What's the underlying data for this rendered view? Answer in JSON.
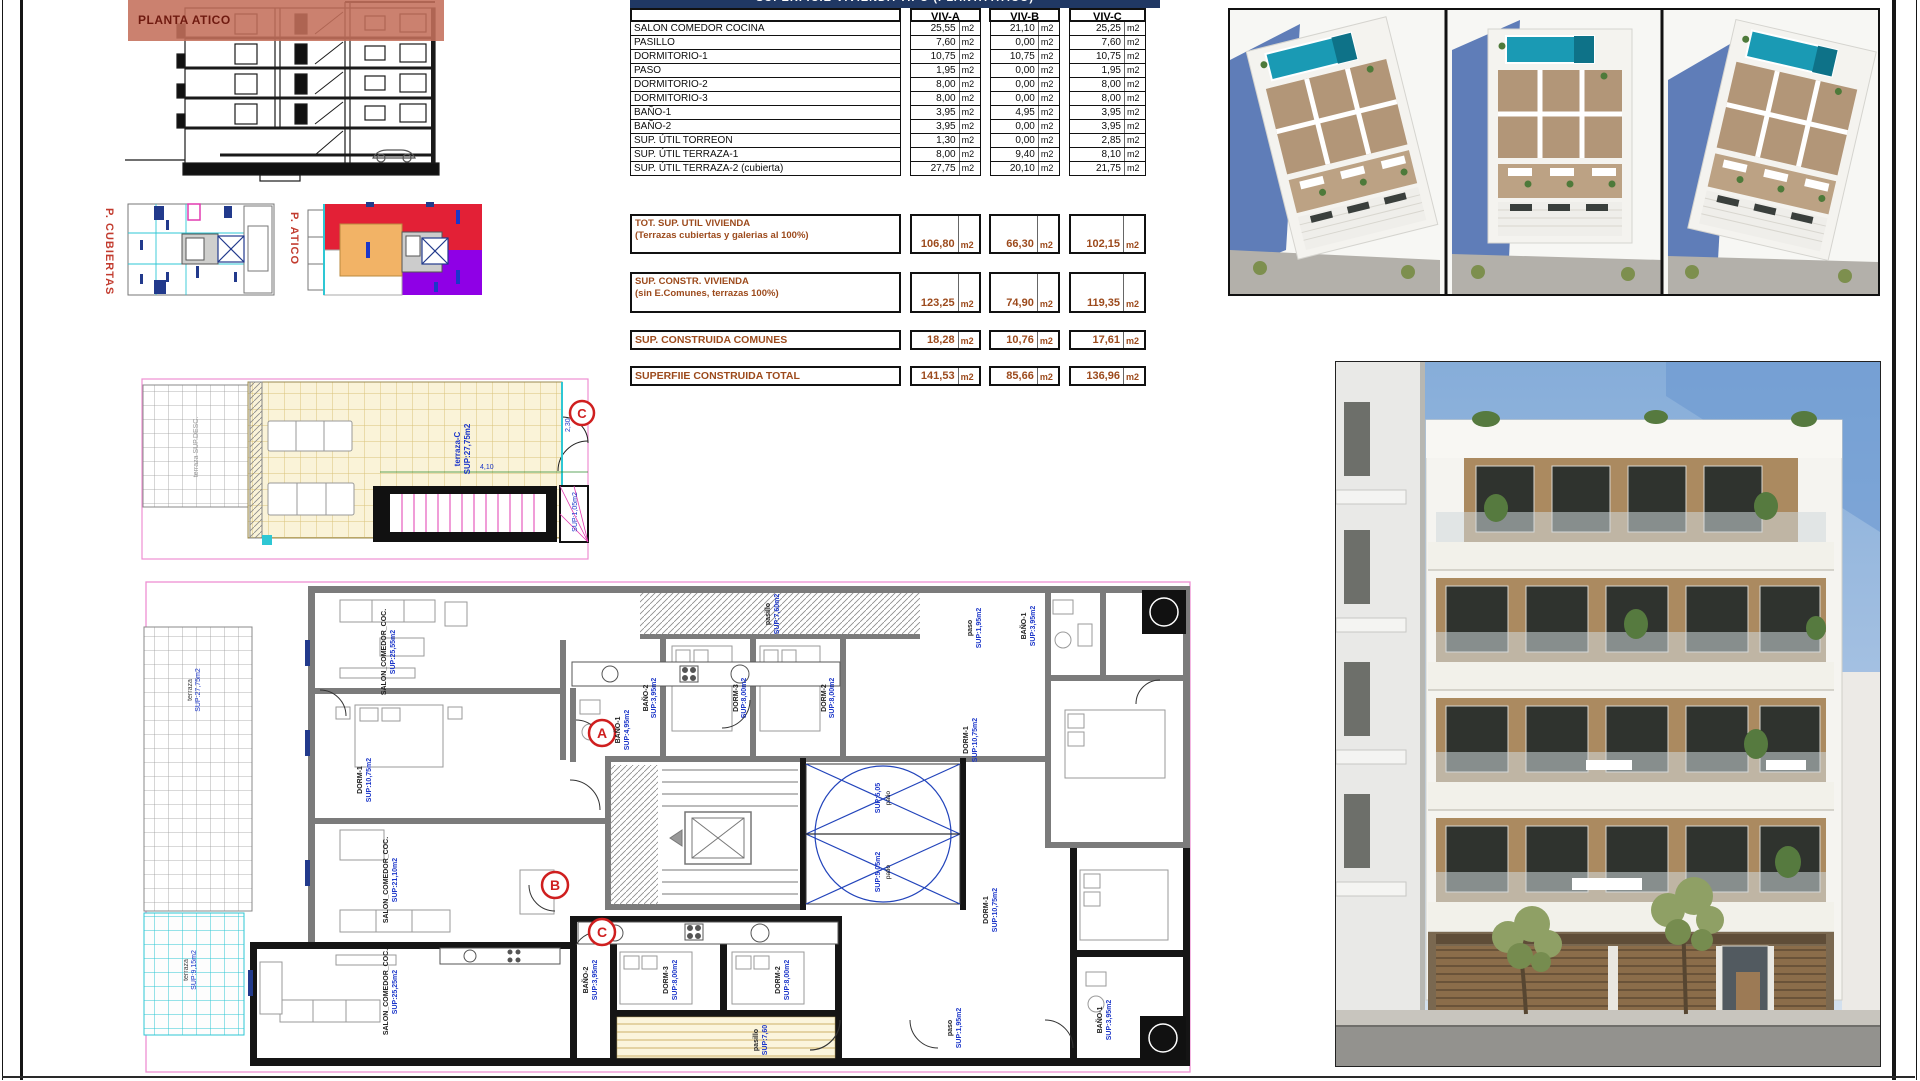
{
  "sheet": {
    "section_label": "PLANTA ATICO",
    "roof_plan_label": "P. CUBIERTAS",
    "atico_plan_label": "P. ATICO"
  },
  "table": {
    "title": "SUPERFICIE VIVIENDA TIPO (PLANTA ATICO)",
    "columns": [
      "VIV-A",
      "VIV-B",
      "VIV-C"
    ],
    "unit": "m2",
    "rows": [
      {
        "label": "SALON COMEDOR COCINA",
        "values": [
          "25,55",
          "21,10",
          "25,25"
        ]
      },
      {
        "label": "PASILLO",
        "values": [
          "7,60",
          "0,00",
          "7,60"
        ]
      },
      {
        "label": "DORMITORIO-1",
        "values": [
          "10,75",
          "10,75",
          "10,75"
        ]
      },
      {
        "label": "PASO",
        "values": [
          "1,95",
          "0,00",
          "1,95"
        ]
      },
      {
        "label": "DORMITORIO-2",
        "values": [
          "8,00",
          "0,00",
          "8,00"
        ]
      },
      {
        "label": "DORMITORIO-3",
        "values": [
          "8,00",
          "0,00",
          "8,00"
        ]
      },
      {
        "label": "BAÑO-1",
        "values": [
          "3,95",
          "4,95",
          "3,95"
        ]
      },
      {
        "label": "BAÑO-2",
        "values": [
          "3,95",
          "0,00",
          "3,95"
        ]
      },
      {
        "label": "SUP. ÚTIL TORREON",
        "values": [
          "1,30",
          "0,00",
          "2,85"
        ]
      },
      {
        "label": "SUP. ÚTIL TERRAZA-1",
        "values": [
          "8,00",
          "9,40",
          "8,10"
        ]
      },
      {
        "label": "SUP. ÚTIL TERRAZA-2 (cubierta)",
        "values": [
          "27,75",
          "20,10",
          "21,75"
        ]
      }
    ],
    "summary_rows": [
      {
        "label": "TOT. SUP. UTIL VIVIENDA",
        "sublabel": "(Terrazas cubiertas y galerias al 100%)",
        "values": [
          "106,80",
          "66,30",
          "102,15"
        ],
        "twoLine": true,
        "gap": 38,
        "height": 40
      },
      {
        "label": "SUP. CONSTR. VIVIENDA",
        "sublabel": "(sin E.Comunes, terrazas 100%)",
        "values": [
          "123,25",
          "74,90",
          "119,35"
        ],
        "twoLine": true,
        "gap": 18,
        "height": 41
      },
      {
        "label": "SUP. CONSTRUIDA COMUNES",
        "sublabel": "",
        "values": [
          "18,28",
          "10,76",
          "17,61"
        ],
        "twoLine": false,
        "gap": 17,
        "height": 20
      },
      {
        "label": "SUPERFIIE CONSTRUIDA TOTAL",
        "sublabel": "",
        "values": [
          "141,53",
          "85,66",
          "136,96"
        ],
        "twoLine": false,
        "gap": 16,
        "height": 20
      }
    ]
  },
  "terrace_plan": {
    "marker": "C",
    "room_label": "terraza-C",
    "area_label": "SUP:27,75m2",
    "stair_area_label": "SUP:1,05m2",
    "dim_a": "2,30",
    "dim_b": "4,10"
  },
  "floor_plan": {
    "markers": {
      "a": "A",
      "b": "B",
      "c": "C"
    },
    "labels": {
      "salon_a": "SALON_COMEDOR_COC.",
      "salon_a_area": "SUP:25,55m2",
      "salon_b": "SALON_COMEDOR_COC.",
      "salon_b_area": "SUP:21,10m2",
      "salon_c": "SALON_COMEDOR_COC.",
      "salon_c_area": "SUP:25,25m2",
      "dorm1_a": "DORM-1",
      "dorm1_a_area": "SUP:10,75m2",
      "bano1_b": "BAÑO-1",
      "bano1_b_area": "SUP:4,95m2",
      "bano2_top": "BAÑO-2",
      "bano2_top_area": "SUP:3,95m2",
      "dorm3_top": "DORM-3",
      "dorm3_top_area": "SUP:8,00m2",
      "dorm2_top": "DORM-2",
      "dorm2_top_area": "SUP:8,00m2",
      "pasillo_top": "pasillo",
      "pasillo_top_area": "SUP:7,60m2",
      "paso_top": "paso",
      "paso_top_area": "SUP:1,95m2",
      "bano1_tr": "BAÑO-1",
      "bano1_tr_area": "SUP:3,95m2",
      "dorm1_tr": "DORM-1",
      "dorm1_tr_area": "SUP:10,75m2",
      "patio_top": "patio",
      "patio_top_area": "SUP:5,05",
      "patio_bottom": "patio",
      "patio_bottom_area": "SUP:5,05m2",
      "bano2_c": "BAÑO-2",
      "bano2_c_area": "SUP:3,95m2",
      "dorm3_c": "DORM-3",
      "dorm3_c_area": "SUP:8,00m2",
      "dorm2_c": "DORM-2",
      "dorm2_c_area": "SUP:8,00m2",
      "pasillo_c": "pasillo",
      "pasillo_c_area": "SUP:7,60",
      "paso_c": "paso",
      "paso_c_area": "SUP:1,95m2",
      "bano1_c": "BAÑO-1",
      "bano1_c_area": "SUP:3,95m2",
      "dorm1_c": "DORM-1",
      "dorm1_c_area": "SUP:10,75m2",
      "terraza_left": "terraza",
      "terraza_left_area": "SUP:27,75m2",
      "terraza_cyan": "terraza",
      "terraza_cyan_area": "SUP:9,15m2"
    }
  },
  "colors": {
    "table_title_bg": "#203864",
    "summary_text": "#9c4a1c",
    "section_highlight": "#c46f5b",
    "marker_red": "#cf1f1f",
    "plan_label_blue": "#1b36c9",
    "plan_boundary_pink": "#ee8fd2",
    "terrace_tile": "#faf3d8",
    "terrace_grid": "#d9c37a",
    "cyan_grid": "#2ec7d4",
    "atico_red": "#e32036",
    "atico_purple": "#8f00e6",
    "atico_orange": "#f2b366",
    "pool_teal": "#1a9ab4",
    "shadow_blue": "#5f7db8",
    "sky_blue": "#86add9"
  }
}
